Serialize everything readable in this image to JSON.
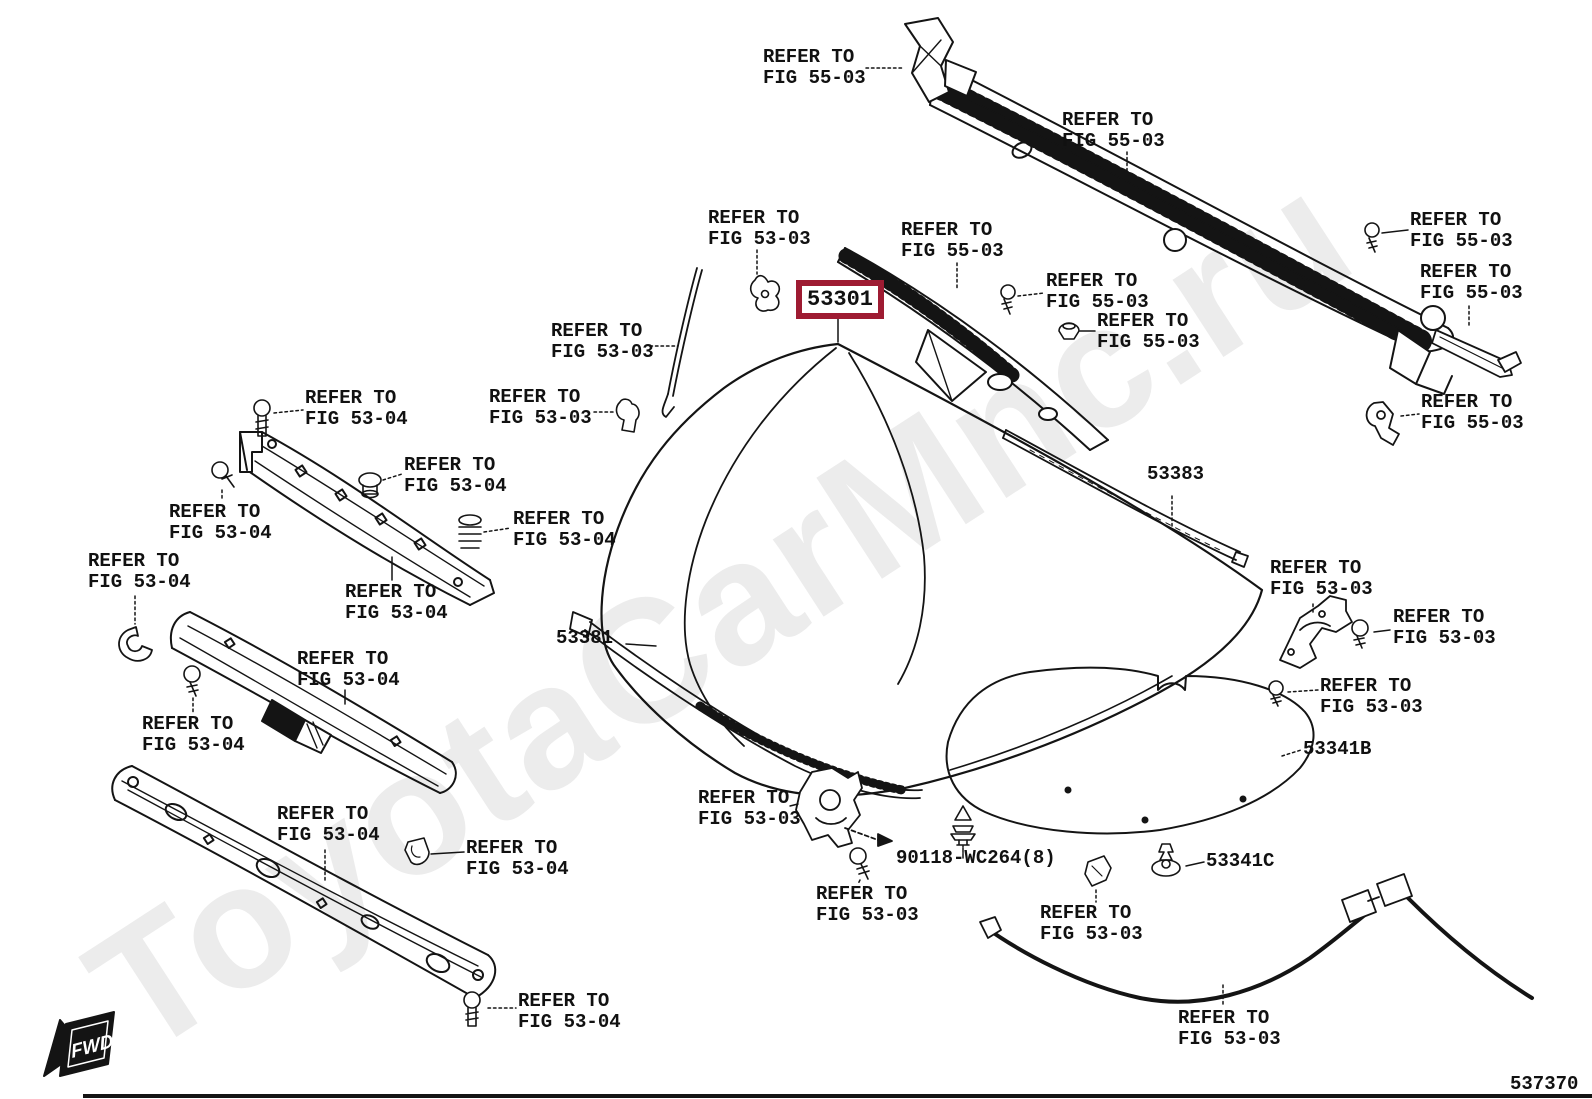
{
  "diagram": {
    "number": "537370",
    "fwd_label": "FWD",
    "watermark": "ToyotaCarMnc.ru",
    "colors": {
      "line": "#141414",
      "highlight_box": "#9e1b32",
      "watermark": "#ececec"
    }
  },
  "highlight": {
    "part_number": "53301"
  },
  "part_numbers": [
    {
      "name": "part-53383",
      "text": "53383",
      "x": 1147,
      "y": 464
    },
    {
      "name": "part-53381",
      "text": "53381",
      "x": 556,
      "y": 628
    },
    {
      "name": "part-53341B",
      "text": "53341B",
      "x": 1303,
      "y": 739
    },
    {
      "name": "part-53341C",
      "text": "53341C",
      "x": 1206,
      "y": 851
    },
    {
      "name": "part-90118-wc264",
      "text": "90118-WC264(8)",
      "x": 896,
      "y": 848
    }
  ],
  "ref_labels": [
    {
      "name": "ref-fig-55-03-1",
      "x": 763,
      "y": 47,
      "lines": [
        "REFER TO",
        "FIG 55-03"
      ]
    },
    {
      "name": "ref-fig-55-03-2",
      "x": 1062,
      "y": 110,
      "lines": [
        "REFER TO",
        "FIG 55-03"
      ]
    },
    {
      "name": "ref-fig-53-03-1",
      "x": 708,
      "y": 208,
      "lines": [
        "REFER TO",
        "FIG 53-03"
      ]
    },
    {
      "name": "ref-fig-55-03-3",
      "x": 901,
      "y": 220,
      "lines": [
        "REFER TO",
        "FIG 55-03"
      ]
    },
    {
      "name": "ref-fig-55-03-4",
      "x": 1046,
      "y": 271,
      "lines": [
        "REFER TO",
        "FIG 55-03"
      ]
    },
    {
      "name": "ref-fig-55-03-5",
      "x": 1097,
      "y": 311,
      "lines": [
        "REFER TO",
        "FIG 55-03"
      ]
    },
    {
      "name": "ref-fig-55-03-6",
      "x": 1410,
      "y": 210,
      "lines": [
        "REFER TO",
        "FIG 55-03"
      ]
    },
    {
      "name": "ref-fig-55-03-7",
      "x": 1420,
      "y": 262,
      "lines": [
        "REFER TO",
        "FIG 55-03"
      ]
    },
    {
      "name": "ref-fig-55-03-8",
      "x": 1421,
      "y": 392,
      "lines": [
        "REFER TO",
        "FIG 55-03"
      ]
    },
    {
      "name": "ref-fig-53-03-2",
      "x": 551,
      "y": 321,
      "lines": [
        "REFER TO",
        "FIG 53-03"
      ]
    },
    {
      "name": "ref-fig-53-03-3",
      "x": 489,
      "y": 387,
      "lines": [
        "REFER TO",
        "FIG 53-03"
      ]
    },
    {
      "name": "ref-fig-53-04-1",
      "x": 305,
      "y": 388,
      "lines": [
        "REFER TO",
        "FIG 53-04"
      ]
    },
    {
      "name": "ref-fig-53-04-2",
      "x": 169,
      "y": 502,
      "lines": [
        "REFER TO",
        "FIG 53-04"
      ]
    },
    {
      "name": "ref-fig-53-04-3",
      "x": 404,
      "y": 455,
      "lines": [
        "REFER TO",
        "FIG 53-04"
      ]
    },
    {
      "name": "ref-fig-53-04-4",
      "x": 513,
      "y": 509,
      "lines": [
        "REFER TO",
        "FIG 53-04"
      ]
    },
    {
      "name": "ref-fig-53-04-5",
      "x": 88,
      "y": 551,
      "lines": [
        "REFER TO",
        "FIG 53-04"
      ]
    },
    {
      "name": "ref-fig-53-04-6",
      "x": 345,
      "y": 582,
      "lines": [
        "REFER TO",
        "FIG 53-04"
      ]
    },
    {
      "name": "ref-fig-53-04-7",
      "x": 297,
      "y": 649,
      "lines": [
        "REFER TO",
        "FIG 53-04"
      ]
    },
    {
      "name": "ref-fig-53-04-8",
      "x": 142,
      "y": 714,
      "lines": [
        "REFER TO",
        "FIG 53-04"
      ]
    },
    {
      "name": "ref-fig-53-04-9",
      "x": 277,
      "y": 804,
      "lines": [
        "REFER TO",
        "FIG 53-04"
      ]
    },
    {
      "name": "ref-fig-53-04-10",
      "x": 466,
      "y": 838,
      "lines": [
        "REFER TO",
        "FIG 53-04"
      ]
    },
    {
      "name": "ref-fig-53-04-11",
      "x": 518,
      "y": 991,
      "lines": [
        "REFER TO",
        "FIG 53-04"
      ]
    },
    {
      "name": "ref-fig-53-03-4",
      "x": 698,
      "y": 788,
      "lines": [
        "REFER TO",
        "FIG 53-03"
      ]
    },
    {
      "name": "ref-fig-53-03-5",
      "x": 816,
      "y": 884,
      "lines": [
        "REFER TO",
        "FIG 53-03"
      ]
    },
    {
      "name": "ref-fig-53-03-6",
      "x": 1040,
      "y": 903,
      "lines": [
        "REFER TO",
        "FIG 53-03"
      ]
    },
    {
      "name": "ref-fig-53-03-7",
      "x": 1178,
      "y": 1008,
      "lines": [
        "REFER TO",
        "FIG 53-03"
      ]
    },
    {
      "name": "ref-fig-53-03-8",
      "x": 1270,
      "y": 558,
      "lines": [
        "REFER TO",
        "FIG 53-03"
      ]
    },
    {
      "name": "ref-fig-53-03-9",
      "x": 1393,
      "y": 607,
      "lines": [
        "REFER TO",
        "FIG 53-03"
      ]
    },
    {
      "name": "ref-fig-53-03-10",
      "x": 1320,
      "y": 676,
      "lines": [
        "REFER TO",
        "FIG 53-03"
      ]
    }
  ]
}
